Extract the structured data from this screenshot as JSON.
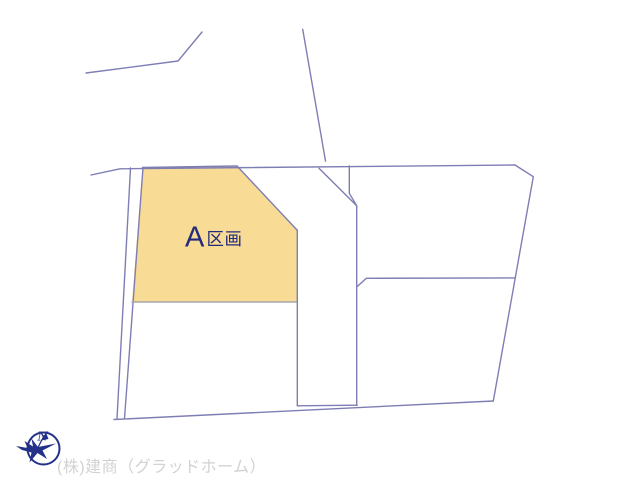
{
  "map": {
    "parcel_a": {
      "label_letter": "A",
      "label_suffix": "区画"
    }
  },
  "compass": {
    "north_label": "N"
  },
  "footer": {
    "company": "(株)建商（グラッドホーム）"
  },
  "colors": {
    "background": "#ffffff",
    "line": "#7e7eb4",
    "gray_line": "#a6a6ae",
    "parcel_fill": "#f8db95",
    "label": "#232a7e",
    "compass": "#233189",
    "footer_text": "#d2d2d2"
  }
}
